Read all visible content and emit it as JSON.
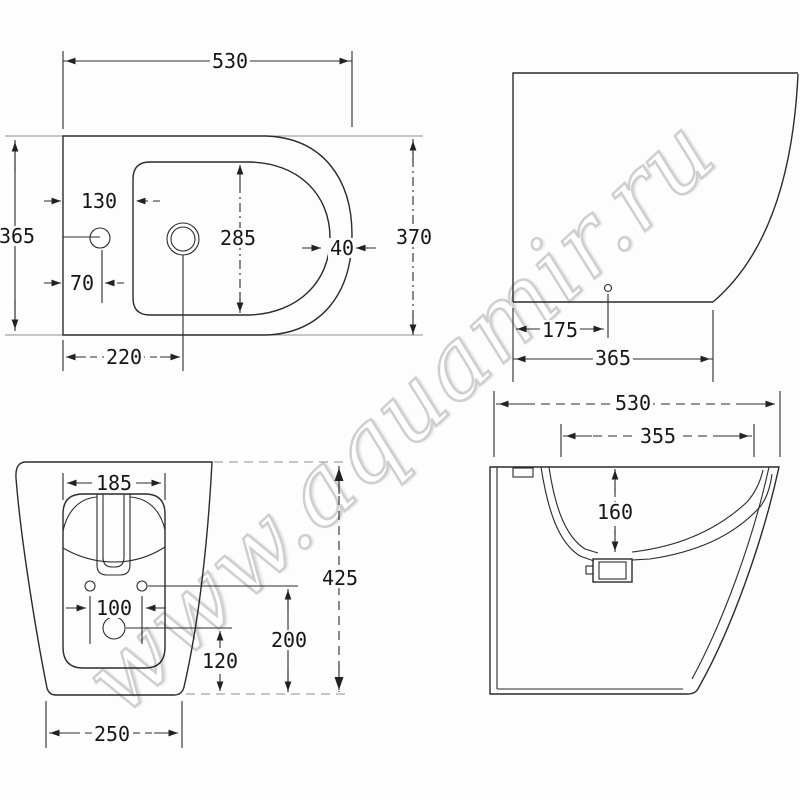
{
  "watermark": "www.aquamir.ru",
  "views": {
    "plan": {
      "label": "top view",
      "dims": {
        "overall_width": "530",
        "overall_depth": "365",
        "tap_hole_offset": "130",
        "tap_hole_center": "70",
        "bowl_length": "285",
        "rim_width": "40",
        "total_depth": "370",
        "drain_offset": "220"
      }
    },
    "side": {
      "label": "side view",
      "dims": {
        "drain_to_back": "175",
        "base_depth": "365"
      }
    },
    "rear": {
      "label": "rear view",
      "dims": {
        "opening_width": "185",
        "fixing_holes_spacing": "100",
        "drain_center_height": "120",
        "fixing_holes_height": "200",
        "overall_height": "425",
        "base_width": "250"
      }
    },
    "section": {
      "label": "section view",
      "dims": {
        "overall_width": "530",
        "inner_width": "355",
        "bowl_depth": "160"
      }
    }
  }
}
